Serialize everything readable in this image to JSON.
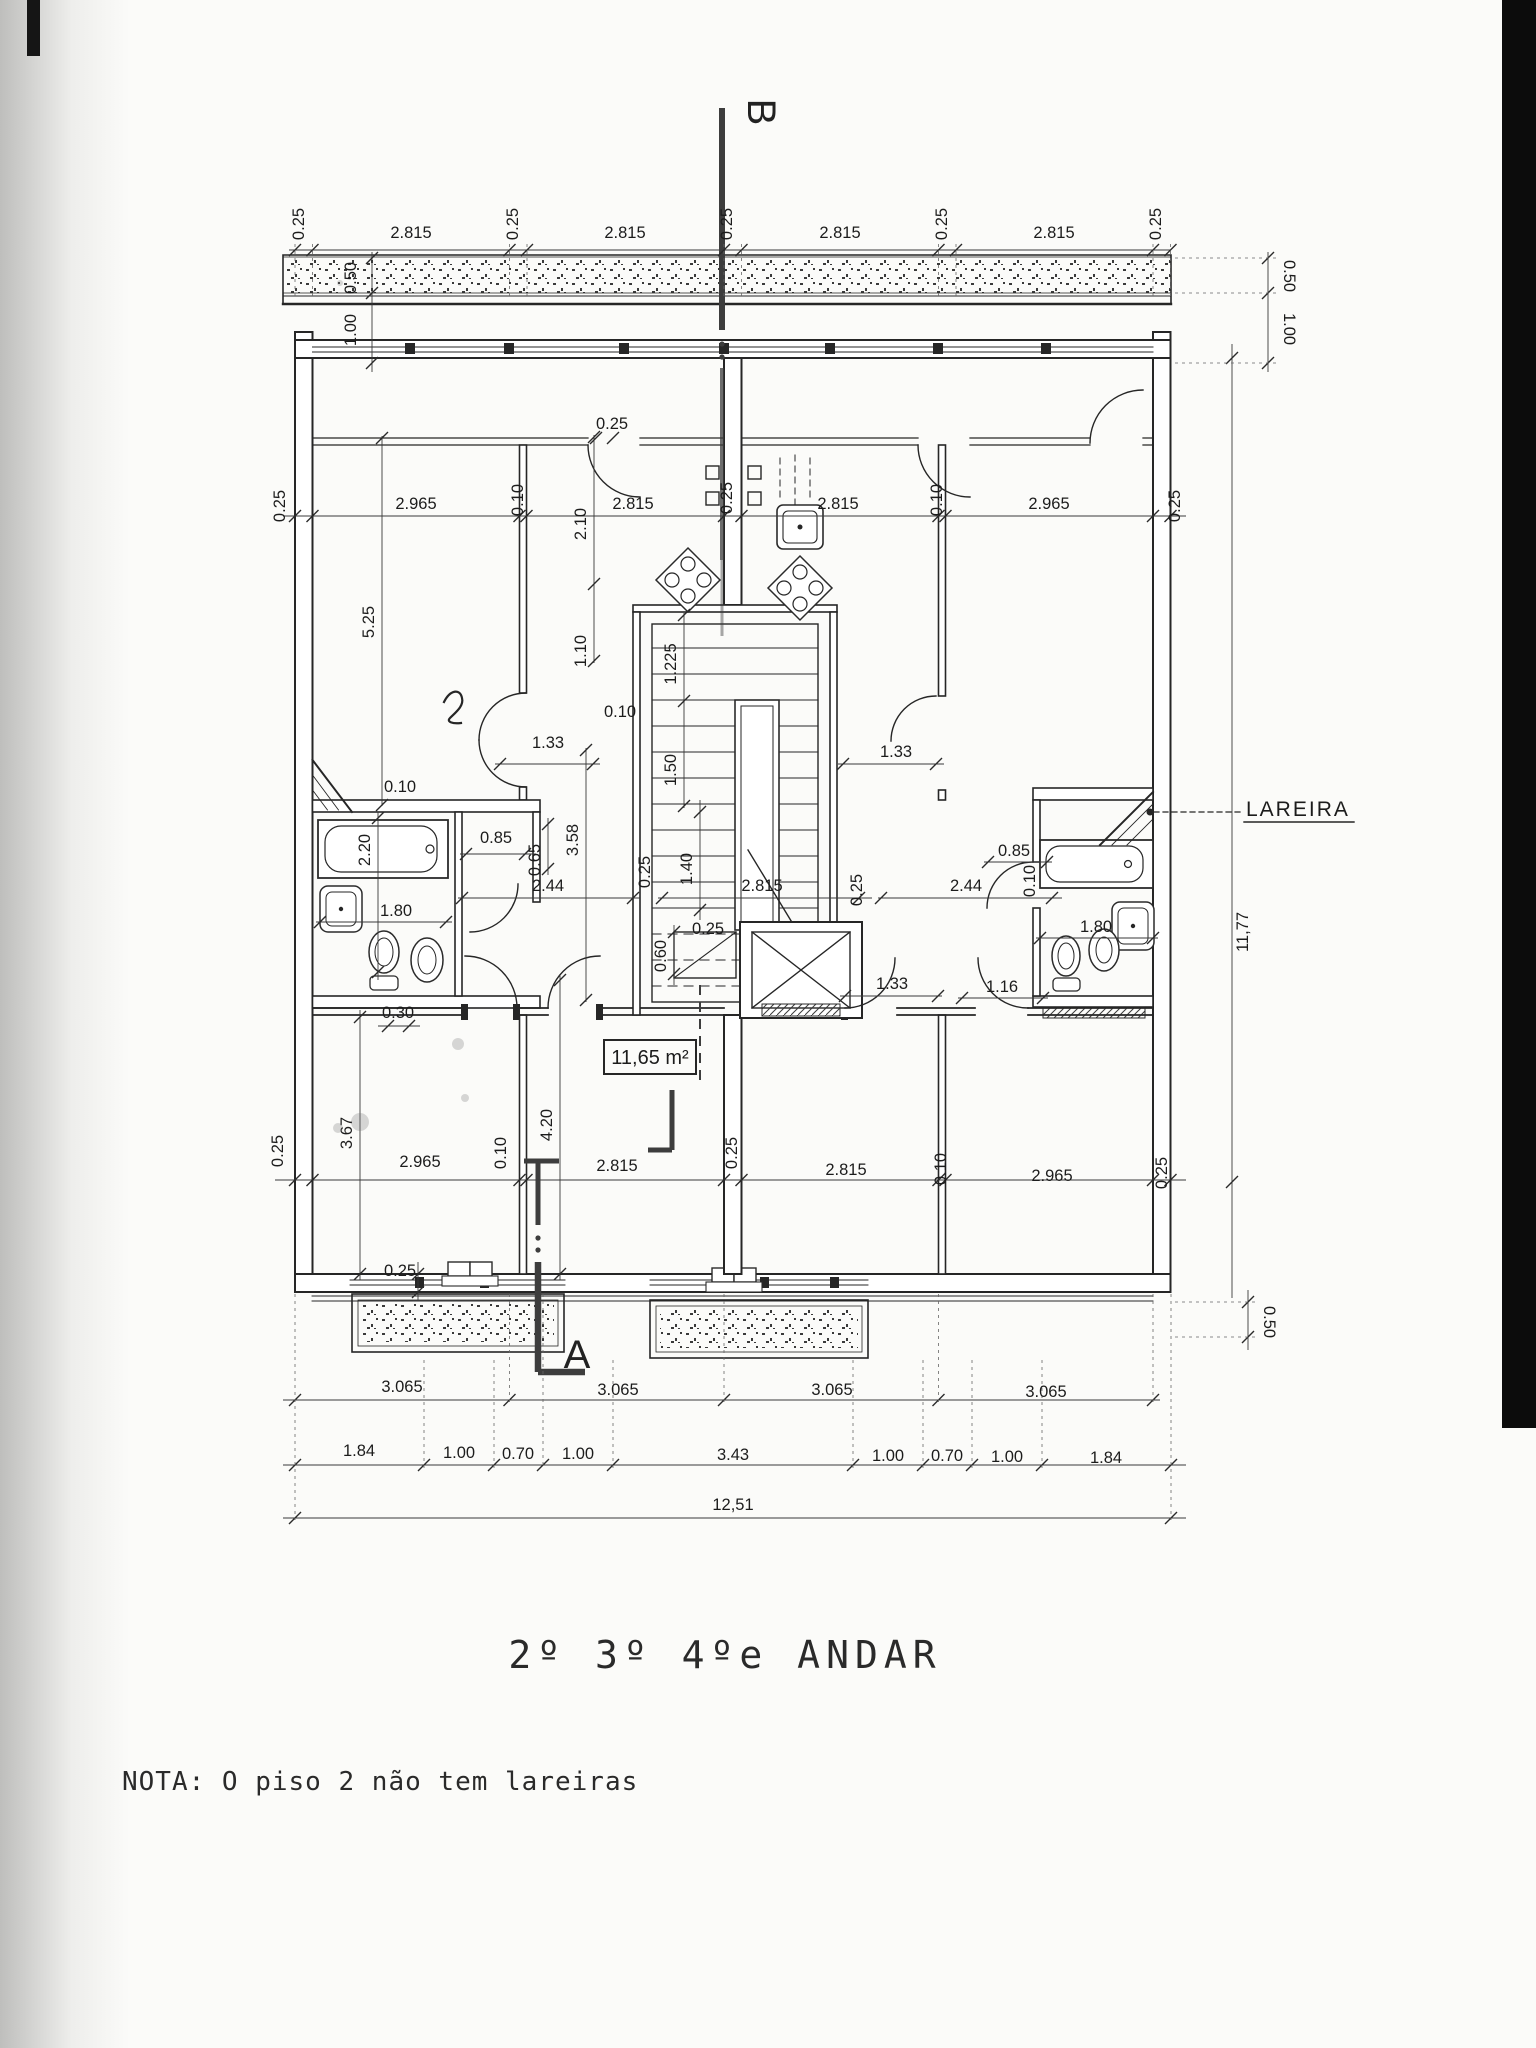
{
  "plan": {
    "title": "2º 3º 4ºe ANDAR",
    "note": "NOTA: O piso 2 não tem lareiras",
    "section_label_a": "A",
    "section_label_b": "B",
    "fireplace_label": "LAREIRA",
    "area_label": "11,65 m²",
    "dims": [
      {
        "v": "0.25",
        "x": 304,
        "y": 224,
        "r": -90
      },
      {
        "v": "2.815",
        "x": 411,
        "y": 238
      },
      {
        "v": "0.25",
        "x": 518,
        "y": 224,
        "r": -90
      },
      {
        "v": "2.815",
        "x": 625,
        "y": 238
      },
      {
        "v": "0.25",
        "x": 732,
        "y": 224,
        "r": -90
      },
      {
        "v": "2.815",
        "x": 840,
        "y": 238
      },
      {
        "v": "0.25",
        "x": 947,
        "y": 224,
        "r": -90
      },
      {
        "v": "2.815",
        "x": 1054,
        "y": 238
      },
      {
        "v": "0.25",
        "x": 1161,
        "y": 224,
        "r": -90
      },
      {
        "v": "0.50",
        "x": 356,
        "y": 278,
        "r": -90
      },
      {
        "v": "1.00",
        "x": 356,
        "y": 330,
        "r": -90
      },
      {
        "v": "0.50",
        "x": 1284,
        "y": 276,
        "r": 90
      },
      {
        "v": "1.00",
        "x": 1284,
        "y": 329,
        "r": 90
      },
      {
        "v": "0.25",
        "x": 285,
        "y": 506,
        "r": -90
      },
      {
        "v": "2.965",
        "x": 416,
        "y": 509
      },
      {
        "v": "0.10",
        "x": 523,
        "y": 500,
        "r": -90
      },
      {
        "v": "2.815",
        "x": 633,
        "y": 509
      },
      {
        "v": "0.25",
        "x": 732,
        "y": 498,
        "r": -90
      },
      {
        "v": "2.815",
        "x": 838,
        "y": 509
      },
      {
        "v": "0.10",
        "x": 942,
        "y": 500,
        "r": -90
      },
      {
        "v": "2.965",
        "x": 1049,
        "y": 509
      },
      {
        "v": "0.25",
        "x": 1180,
        "y": 506,
        "r": -90
      },
      {
        "v": "0.25",
        "x": 612,
        "y": 429
      },
      {
        "v": "2.10",
        "x": 586,
        "y": 524,
        "r": -90
      },
      {
        "v": "1.10",
        "x": 586,
        "y": 651,
        "r": -90
      },
      {
        "v": "5.25",
        "x": 374,
        "y": 622,
        "r": -90
      },
      {
        "v": "1.225",
        "x": 676,
        "y": 664,
        "r": -90
      },
      {
        "v": "1.50",
        "x": 676,
        "y": 770,
        "r": -90
      },
      {
        "v": "0.10",
        "x": 620,
        "y": 717
      },
      {
        "v": "1.33",
        "x": 548,
        "y": 748
      },
      {
        "v": "1.33",
        "x": 896,
        "y": 757
      },
      {
        "v": "3.58",
        "x": 578,
        "y": 840,
        "r": -90
      },
      {
        "v": "0.10",
        "x": 400,
        "y": 792
      },
      {
        "v": "2.20",
        "x": 370,
        "y": 850,
        "r": -90
      },
      {
        "v": "0.85",
        "x": 496,
        "y": 843
      },
      {
        "v": "0.65",
        "x": 540,
        "y": 860,
        "r": -90
      },
      {
        "v": "2.44",
        "x": 548,
        "y": 891
      },
      {
        "v": "1.80",
        "x": 396,
        "y": 916
      },
      {
        "v": "0.30",
        "x": 398,
        "y": 1018
      },
      {
        "v": "0.25",
        "x": 650,
        "y": 872,
        "r": -90
      },
      {
        "v": "1.40",
        "x": 692,
        "y": 869,
        "r": -90
      },
      {
        "v": "2.815",
        "x": 762,
        "y": 891
      },
      {
        "v": "0.25",
        "x": 862,
        "y": 890,
        "r": -90
      },
      {
        "v": "2.44",
        "x": 966,
        "y": 891
      },
      {
        "v": "0.85",
        "x": 1014,
        "y": 856
      },
      {
        "v": "0.10",
        "x": 1035,
        "y": 881,
        "r": -90
      },
      {
        "v": "1.80",
        "x": 1096,
        "y": 932
      },
      {
        "v": "0.25",
        "x": 708,
        "y": 934
      },
      {
        "v": "0.60",
        "x": 666,
        "y": 956,
        "r": -90
      },
      {
        "v": "1.33",
        "x": 892,
        "y": 989
      },
      {
        "v": "1.16",
        "x": 1002,
        "y": 992
      },
      {
        "v": "11,77",
        "x": 1248,
        "y": 932,
        "r": -90
      },
      {
        "v": "0.25",
        "x": 283,
        "y": 1151,
        "r": -90
      },
      {
        "v": "3.67",
        "x": 352,
        "y": 1133,
        "r": -90
      },
      {
        "v": "2.965",
        "x": 420,
        "y": 1167
      },
      {
        "v": "0.10",
        "x": 506,
        "y": 1153,
        "r": -90
      },
      {
        "v": "4.20",
        "x": 552,
        "y": 1125,
        "r": -90
      },
      {
        "v": "2.815",
        "x": 617,
        "y": 1171
      },
      {
        "v": "0.25",
        "x": 737,
        "y": 1153,
        "r": -90
      },
      {
        "v": "2.815",
        "x": 846,
        "y": 1175
      },
      {
        "v": "0.10",
        "x": 946,
        "y": 1169,
        "r": -90
      },
      {
        "v": "2.965",
        "x": 1052,
        "y": 1181
      },
      {
        "v": "0.25",
        "x": 1167,
        "y": 1173,
        "r": -90
      },
      {
        "v": "0.25",
        "x": 400,
        "y": 1276
      },
      {
        "v": "0.50",
        "x": 1264,
        "y": 1322,
        "r": 90
      },
      {
        "v": "3.065",
        "x": 402,
        "y": 1392
      },
      {
        "v": "3.065",
        "x": 618,
        "y": 1395
      },
      {
        "v": "3.065",
        "x": 832,
        "y": 1395
      },
      {
        "v": "3.065",
        "x": 1046,
        "y": 1397
      },
      {
        "v": "1.84",
        "x": 359,
        "y": 1456
      },
      {
        "v": "1.00",
        "x": 459,
        "y": 1458
      },
      {
        "v": "0.70",
        "x": 518,
        "y": 1459
      },
      {
        "v": "1.00",
        "x": 578,
        "y": 1459
      },
      {
        "v": "3.43",
        "x": 733,
        "y": 1460
      },
      {
        "v": "1.00",
        "x": 888,
        "y": 1461
      },
      {
        "v": "0.70",
        "x": 947,
        "y": 1461
      },
      {
        "v": "1.00",
        "x": 1007,
        "y": 1462
      },
      {
        "v": "1.84",
        "x": 1106,
        "y": 1463
      },
      {
        "v": "12,51",
        "x": 733,
        "y": 1510
      }
    ]
  }
}
